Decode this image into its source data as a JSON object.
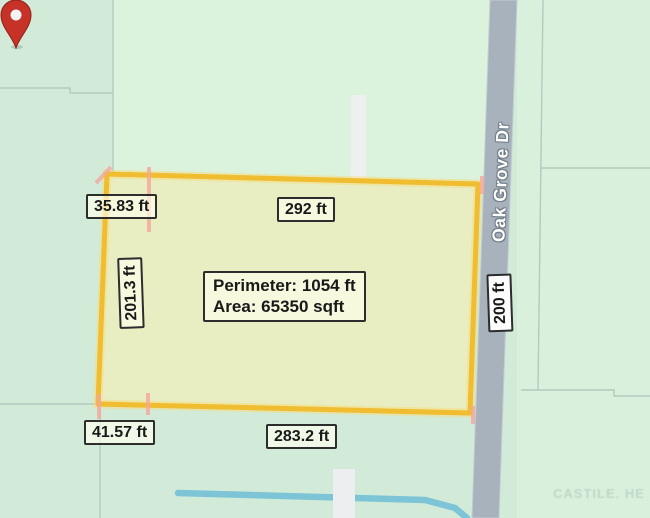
{
  "map": {
    "street_name": "Oak Grove Dr",
    "watermark": "CASTILE. HE",
    "colors": {
      "background": "#d2ebd9",
      "background_upper": "#dbf3dd",
      "parcel_fill": "#e8eec1",
      "parcel_stroke": "#f0bc30",
      "parcel_tick": "#f4a69b",
      "boundary_line": "#b4c9bf",
      "road": "#a8b2bc",
      "creek": "#7cc4d6",
      "pin": "#c63228",
      "label_border": "#2d2d2d"
    }
  },
  "measurements": {
    "summary": {
      "perimeter": "Perimeter: 1054 ft",
      "area": "Area: 65350 sqft"
    },
    "sides": {
      "top_left": "35.83 ft",
      "top": "292 ft",
      "left": "201.3 ft",
      "right": "200 ft",
      "bottom_left": "41.57 ft",
      "bottom": "283.2 ft"
    }
  }
}
